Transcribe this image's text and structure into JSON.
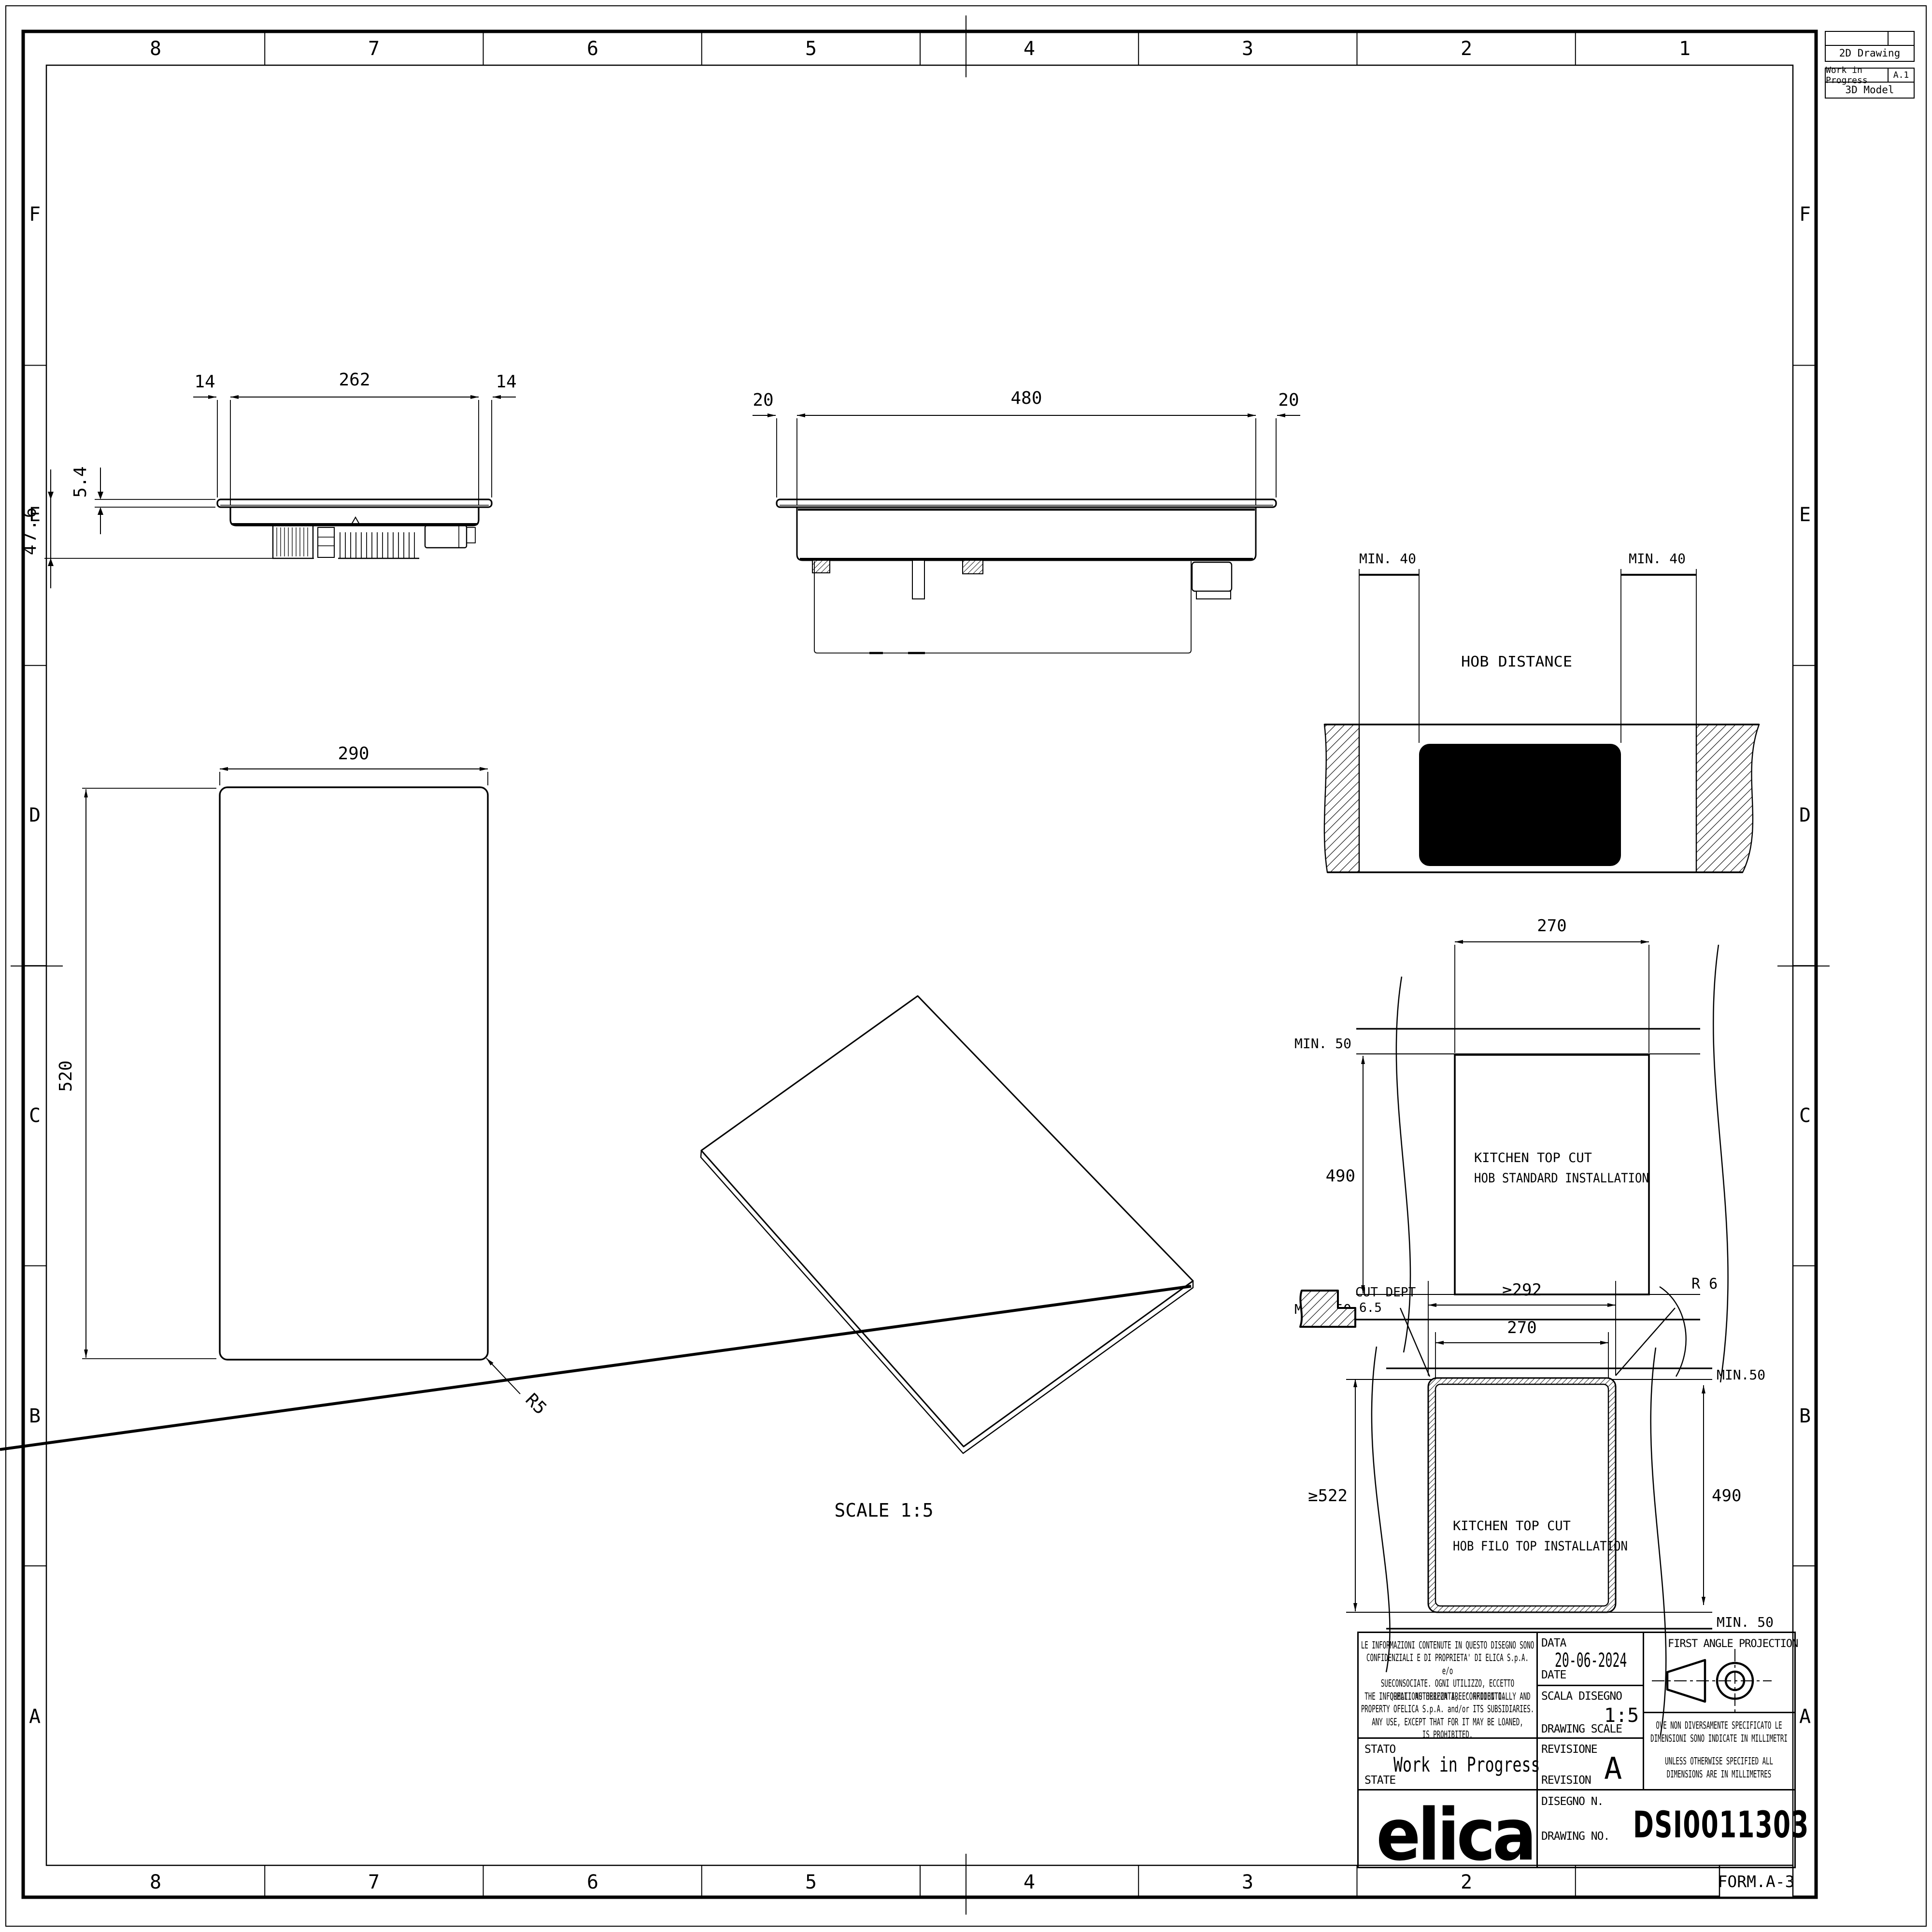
{
  "sheet": {
    "cols": [
      "8",
      "7",
      "6",
      "5",
      "4",
      "3",
      "2",
      "1"
    ],
    "cols_bottom": [
      "8",
      "7",
      "6",
      "5",
      "4",
      "3",
      "2"
    ],
    "rows": [
      "F",
      "E",
      "D",
      "C",
      "B",
      "A"
    ],
    "form": "FORM.A-3",
    "paper_color": "#ffffff",
    "line_color": "#000000"
  },
  "corner": {
    "t1_row2": "2D Drawing",
    "t2_status": "Work in Progress",
    "t2_rev": "A.1",
    "t2_row2": "3D Model"
  },
  "front_view": {
    "dim_left_overhang": "14",
    "dim_body_width": "262",
    "dim_right_overhang": "14",
    "dim_glass_thickness": "5.4",
    "dim_total_height": "47.6"
  },
  "side_view": {
    "dim_left_overhang": "20",
    "dim_body_width": "480",
    "dim_right_overhang": "20"
  },
  "top_view": {
    "dim_width": "290",
    "dim_depth": "520",
    "dim_corner_radius": "R5"
  },
  "iso_view": {
    "scale_label": "SCALE 1:5"
  },
  "hob_distance_view": {
    "title": "HOB DISTANCE",
    "dim_min_left": "MIN. 40",
    "dim_min_right": "MIN. 40"
  },
  "standard_install_view": {
    "dim_cut_width": "270",
    "dim_cut_depth": "490",
    "dim_min_top": "MIN. 50",
    "dim_min_bottom": "MIN. 50",
    "label_line1": "KITCHEN TOP CUT",
    "label_line2": "HOB STANDARD INSTALLATION"
  },
  "filo_install_view": {
    "cut_depth_label": "CUT DEPT",
    "cut_depth_value": "6.5",
    "dim_outer_width": "≥292",
    "dim_inner_width": "270",
    "dim_radius": "R 6",
    "dim_min_top": "MIN.50",
    "dim_min_bottom": "MIN. 50",
    "dim_outer_depth": "≥522",
    "dim_inner_depth": "490",
    "label_line1": "KITCHEN TOP CUT",
    "label_line2": "HOB FILO TOP INSTALLATION"
  },
  "title_block": {
    "legal_it": "LE INFORMAZIONI CONTENUTE IN QUESTO DISEGNO SONO\nCONFIDENZIALI E DI PROPRIETA' DI ELICA S.p.A. e/o\nSUECONSOCIATE. OGNI UTILIZZO, ECCETTO\nQUELLI AUTORIZZATI, E' PROIBITO.",
    "legal_en": "THE INFORMATIONS HEREON ARE CONFIDENTIALLY AND\nPROPERTY OFELICA S.p.A.  and/or ITS SUBSIDIARIES.\nANY USE, EXCEPT THAT FOR IT MAY BE LOANED,\nIS PROHIBITED.",
    "data_label": "DATA",
    "date_label": "DATE",
    "date_value": "20-06-2024",
    "scala_label": "SCALA DISEGNO",
    "scale_label": "DRAWING SCALE",
    "scale_value": "1:5",
    "stato_label": "STATO",
    "state_label": "STATE",
    "state_value": "Work in Progress",
    "revisione_label": "REVISIONE",
    "revision_label": "REVISION",
    "revision_value": "A",
    "disegno_label": "DISEGNO N.",
    "drawing_no_label": "DRAWING NO.",
    "drawing_no_value": "DSI0011303",
    "projection_label": "FIRST ANGLE PROJECTION",
    "note_it": "OVE NON DIVERSAMENTE SPECIFICATO LE\nDIMENSIONI SONO INDICATE IN MILLIMETRI",
    "note_en": "UNLESS OTHERWISE SPECIFIED ALL\nDIMENSIONS ARE IN MILLIMETRES",
    "brand": "elica"
  }
}
